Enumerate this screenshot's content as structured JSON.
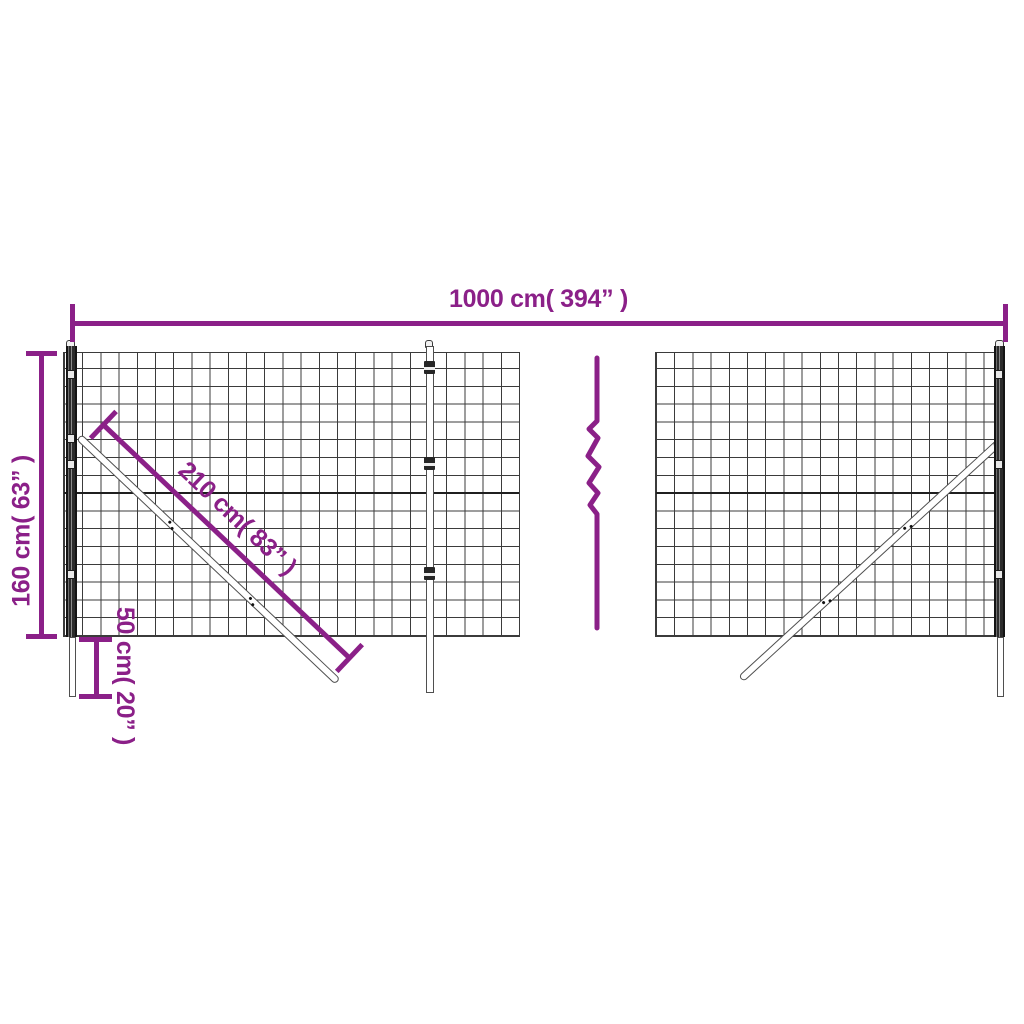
{
  "diagram": {
    "kind": "product dimension diagram",
    "subject": "wire mesh fence panels with posts and diagonal braces",
    "background": "#ffffff",
    "break_symbol": "zigzag-break-icon"
  },
  "colors": {
    "dimension": "#8B2088",
    "mesh_line": "#3b3b3b",
    "mesh_heavy_line": "#1f1f1f",
    "post_dark": "#262626",
    "outline": "#4f4f4f"
  },
  "dimensions": {
    "width": {
      "label": "1000 cm( 394” )"
    },
    "height": {
      "label": "160 cm( 63” )"
    },
    "brace": {
      "label": "210 cm( 83” )"
    },
    "depth": {
      "label": "50 cm( 20” )"
    }
  }
}
